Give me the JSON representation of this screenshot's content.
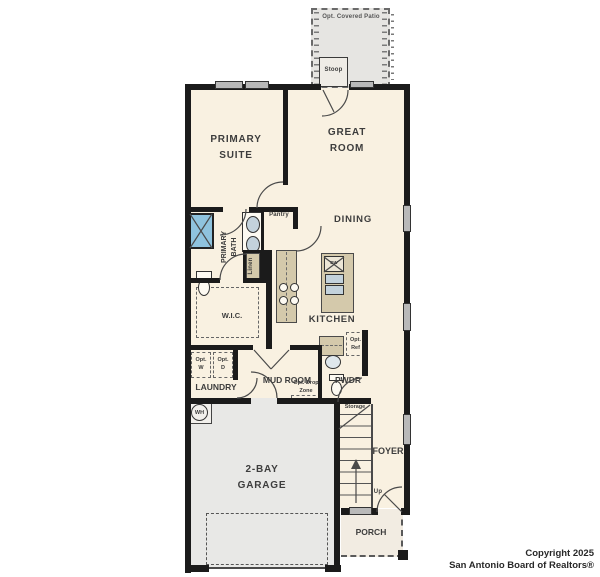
{
  "labels": {
    "patio": "Opt. Covered Patio",
    "stoop": "Stoop",
    "primary_suite": "PRIMARY SUITE",
    "great_room": "GREAT ROOM",
    "dining": "DINING",
    "primary_bath": "PRIMARY BATH",
    "pantry": "Pantry",
    "linen": "Linen",
    "wic": "W.I.C.",
    "kitchen": "KITCHEN",
    "dishwasher": "DW",
    "laundry": "LAUNDRY",
    "opt_washer_line1": "Opt.",
    "opt_washer_line2": "W",
    "opt_dryer_line1": "Opt.",
    "opt_dryer_line2": "D",
    "mud_room": "MUD ROOM",
    "drop_zone_line1": "Opt. Drop",
    "drop_zone_line2": "Zone",
    "powder": "PWDR",
    "opt_ref_line1": "Opt.",
    "opt_ref_line2": "Ref",
    "storage": "Storage",
    "up": "Up",
    "foyer": "FOYER",
    "garage": "2-BAY GARAGE",
    "porch": "PORCH",
    "water_heater": "WH"
  },
  "copyright": {
    "line1": "Copyright 2025",
    "line2": "San Antonio Board of Realtors®"
  },
  "colors": {
    "wall": "#1b1b1b",
    "floor": "#f9f1e1",
    "garage_floor": "#e8e8e6",
    "patio": "#e6e5e2",
    "counter": "#d4c9ab",
    "window": "#b9b9b9",
    "shower": "#8fc3de",
    "sink": "#c3d2dc",
    "label_text": "#3d3d3d"
  }
}
